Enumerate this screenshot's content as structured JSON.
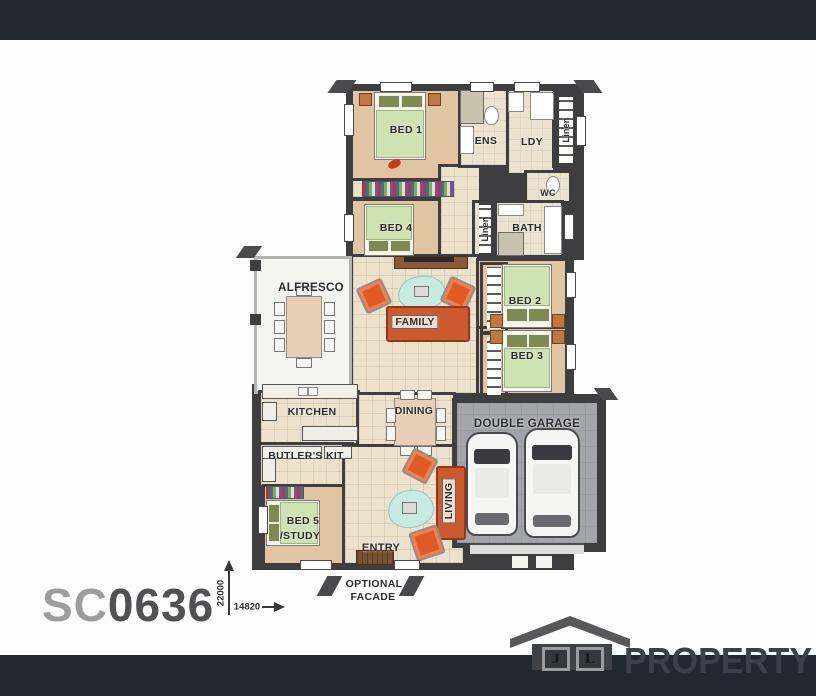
{
  "plan_code": {
    "prefix": "SC",
    "number": "0636"
  },
  "dimensions": {
    "vertical": "22000",
    "horizontal": "14820"
  },
  "rooms": {
    "bed1": "BED 1",
    "ens": "ENS",
    "ldy": "LDY",
    "linen_top": "Linen",
    "bed4": "BED 4",
    "linen_mid": "Linen",
    "wc": "WC",
    "bath": "BATH",
    "alfresco": "ALFRESCO",
    "family": "FAMILY",
    "bed2": "BED 2",
    "bed3": "BED 3",
    "kitchen": "KITCHEN",
    "dining": "DINING",
    "double_garage": "DOUBLE GARAGE",
    "butlers_kit": "BUTLER'S KIT",
    "bed5_line1": "BED 5",
    "bed5_line2": "/STUDY",
    "living": "LIVING",
    "entry": "ENTRY"
  },
  "facade": {
    "line1": "OPTIONAL",
    "line2": "FACADE"
  },
  "brand": {
    "initial_left": "J",
    "initial_right": "L",
    "name": "PROPERTY"
  },
  "icons": {
    "logo": "house-icon"
  },
  "colors": {
    "band": "#212930",
    "wall": "#3e3e41",
    "carpet": "#e1c5a3",
    "tile": "#ece1ca",
    "alfresco_floor": "#f4f4f1",
    "garage_floor": "#a4a5aa",
    "sofa": "#cd5a2e",
    "bed_spread": "#cfe2b2",
    "rug": "#c7ebe3",
    "code_prefix": "#9d9d9d",
    "code_number": "#515154",
    "logo_gray": "#58585b",
    "logo_text": "#3a414a"
  }
}
